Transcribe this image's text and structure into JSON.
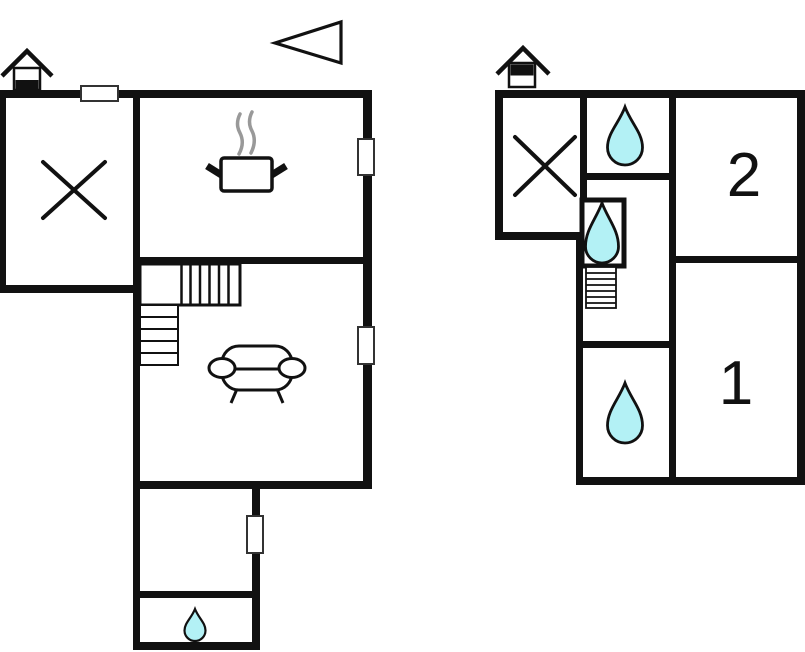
{
  "diagram": {
    "type": "floor-plan",
    "floors": [
      {
        "name": "ground-floor",
        "features": [
          "chimney",
          "excluded-room-cross",
          "kitchen-stove-pot",
          "l-shaped-staircase",
          "sofa",
          "bathroom-water-drop",
          "window-markers"
        ]
      },
      {
        "name": "first-floor",
        "room_labels": {
          "bedroom_1": "1",
          "bedroom_2": "2"
        },
        "features": [
          "chimney",
          "excluded-room-cross",
          "bathroom-water-drop",
          "shower-cabin-water-drop",
          "staircase",
          "bathroom-water-drop-lower"
        ]
      }
    ],
    "compass": "north-arrow-pointing-left"
  },
  "palette": {
    "wall": "#111111",
    "outline": "#111111",
    "background": "#ffffff",
    "water_drop_fill": "#b3f1f5",
    "steam": "#999999",
    "window_border": "#333333"
  }
}
